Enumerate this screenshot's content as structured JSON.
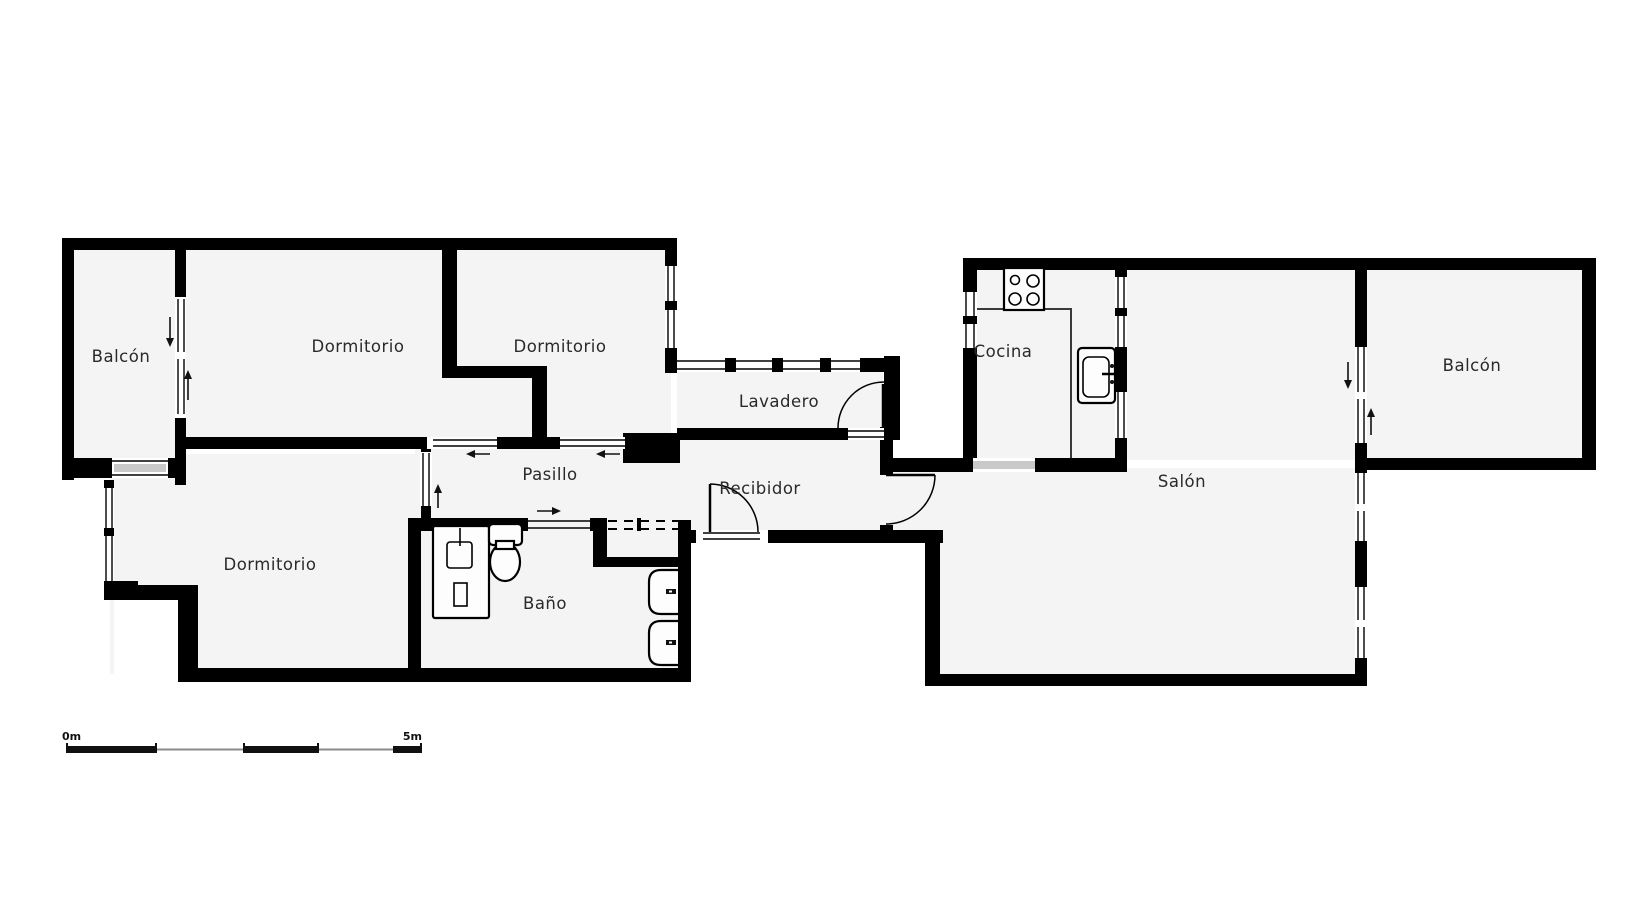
{
  "rooms": {
    "balcon_left": "Balcón",
    "dormitorio_1": "Dormitorio",
    "dormitorio_2": "Dormitorio",
    "dormitorio_3": "Dormitorio",
    "lavadero": "Lavadero",
    "cocina": "Cocina",
    "salon": "Salón",
    "balcon_right": "Balcón",
    "pasillo": "Pasillo",
    "recibidor": "Recibidor",
    "bano": "Baño"
  },
  "scale_bar": {
    "start_label": "0m",
    "end_label": "5m"
  },
  "icons": [
    "stove-icon",
    "kitchen-sink-icon",
    "shower-icon",
    "toilet-icon",
    "washbasin-icon",
    "door-swing-icon",
    "sliding-door-arrow-icon"
  ],
  "colors": {
    "wall": "#000000",
    "floor": "#f4f4f4",
    "opening": "#c9c9c9",
    "text": "#2a2a2a"
  }
}
